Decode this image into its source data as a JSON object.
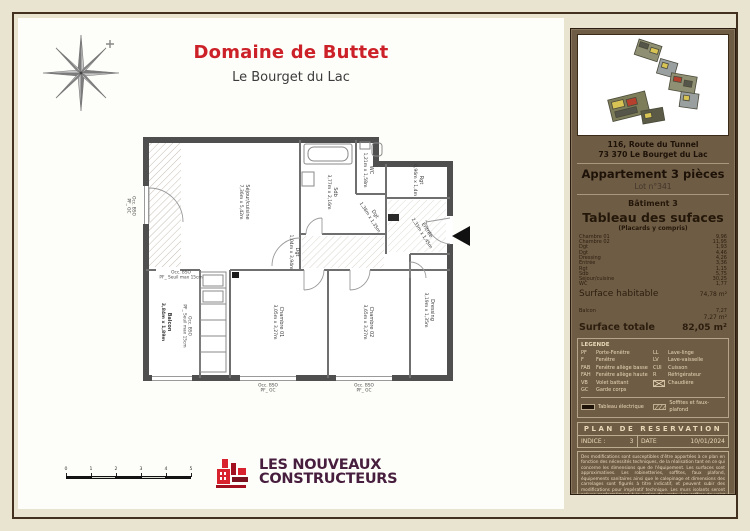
{
  "colors": {
    "accent_red": "#cc2128",
    "panel_brown": "#6f5c45",
    "logo_purple": "#471e3e",
    "page_beige": "#e9e4cf"
  },
  "header": {
    "title": "Domaine de Buttet",
    "subtitle": "Le Bourget du Lac"
  },
  "plan": {
    "rooms": {
      "sejour": {
        "name": "Séjour/cuisine",
        "dims": "7,36m x 5,42m"
      },
      "sdb": {
        "name": "Sdb",
        "dims": "3,77m x 2,16m"
      },
      "wc": {
        "name": "WC",
        "dims": "1,21m x 1,58m"
      },
      "dgt1": {
        "name": "Dgt",
        "dims": "1,38m x 1,35m"
      },
      "rgt": {
        "name": "Rgt",
        "dims": "0,96m x 1,4m"
      },
      "entree": {
        "name": "Entrée",
        "dims": "2,33m x 1,45m"
      },
      "dgt2": {
        "name": "Dgt",
        "dims": "1,04m x 3,94m"
      },
      "chambre01": {
        "name": "Chambre 01",
        "dims": "3,05m x 3,27m"
      },
      "chambre02": {
        "name": "Chambre 02",
        "dims": "3,65m x 3,27m"
      },
      "dressing": {
        "name": "Dressing",
        "dims": "3,19m x 1,35m"
      },
      "balcon": {
        "name": "Balcon",
        "dims": "3,84m x 1,89m"
      }
    },
    "annotations": {
      "occ": "Occ. BSO",
      "seuil": "PF_ Seuil max 15cm",
      "gc": "PF_ GC"
    }
  },
  "scale": {
    "labels": [
      "0",
      "1",
      "2",
      "3",
      "4",
      "5"
    ]
  },
  "logo": {
    "line1": "LES NOUVEAUX",
    "line2": "CONSTRUCTEURS"
  },
  "sidebar": {
    "address_line1": "116, Route du Tunnel",
    "address_line2": "73 370 Le Bourget du Lac",
    "apartment": "Appartement 3 pièces",
    "lot": "Lot n°341",
    "building": "Bâtiment 3",
    "table_title": "Tableau des sufaces",
    "table_subtitle": "(Placards y compris)",
    "rows": [
      {
        "label": "Chambre 01",
        "value": "9,96"
      },
      {
        "label": "Chambre 02",
        "value": "11,95"
      },
      {
        "label": "Dgt",
        "value": "1,93"
      },
      {
        "label": "Dgt",
        "value": "4,46"
      },
      {
        "label": "Dressing",
        "value": "4,26"
      },
      {
        "label": "Entrée",
        "value": "3,36"
      },
      {
        "label": "Rgt",
        "value": "1,15"
      },
      {
        "label": "Sdb",
        "value": "5,75"
      },
      {
        "label": "Séjour/cuisine",
        "value": "30,25"
      },
      {
        "label": "WC",
        "value": "1,77"
      }
    ],
    "habitable_label": "Surface habitable",
    "habitable_value": "74,78 m²",
    "balcon_label": "Balcon",
    "balcon_value": "7,27",
    "exterior_total": "7,27 m²",
    "total_label": "Surface totale",
    "total_value": "82,05 m²"
  },
  "legend": {
    "title": "LEGENDE",
    "left": [
      {
        "abbr": "PF",
        "label": "Porte-Fenêtre"
      },
      {
        "abbr": "F",
        "label": "Fenêtre"
      },
      {
        "abbr": "FAB",
        "label": "Fenêtre allège basse"
      },
      {
        "abbr": "FAH",
        "label": "Fenêtre allège haute"
      },
      {
        "abbr": "VB",
        "label": "Volet battant"
      },
      {
        "abbr": "GC",
        "label": "Garde corps"
      }
    ],
    "right": [
      {
        "abbr": "LL",
        "label": "Lave-linge"
      },
      {
        "abbr": "LV",
        "label": "Lave-vaisselle"
      },
      {
        "abbr": "CUI",
        "label": "Cuisson"
      },
      {
        "abbr": "R",
        "label": "Réfrigérateur"
      }
    ],
    "chaudiere": "Chaudière",
    "extra1": "Tableau électrique",
    "extra2": "Soffites et faux-plafond"
  },
  "reservation": {
    "title": "PLAN DE RESERVATION",
    "indice_label": "INDICE :",
    "indice_value": "3",
    "date_label": "DATE",
    "date_value": "10/01/2024"
  },
  "disclaimer": "Des modifications sont susceptibles d'être apportées à ce plan en fonction des nécessités techniques, de la réalisation tant en ce qui concerne les dimensions que de l'équipement. Les surfaces sont approximatives. Les robinetteries, soffites, faux plafond, équipements sanitaires ainsi que le calepinage et dimensions des carrelages sont figurés à titre indicatif, et peuvent subir des modifications pour impératif technique. Les murs isolants seront prévus conformément à la notice de vente. Les coffres de volet roulant ne sont pas représentés et seront décaissés à l'intérieur. Les appareils ménagers ne sont pas fournis. La hauteur des seuils au droit des porte-fenêtres sur balcons ou terrasses pourra varier de 5 à 20 cm à partir du sol intérieur. La hauteur entre le jardin et la terrasse pourra varier entre 0 et 40 cm. Les jardins ne seront pas nécessairement plats et pourront comporter des talus et des pentes."
}
